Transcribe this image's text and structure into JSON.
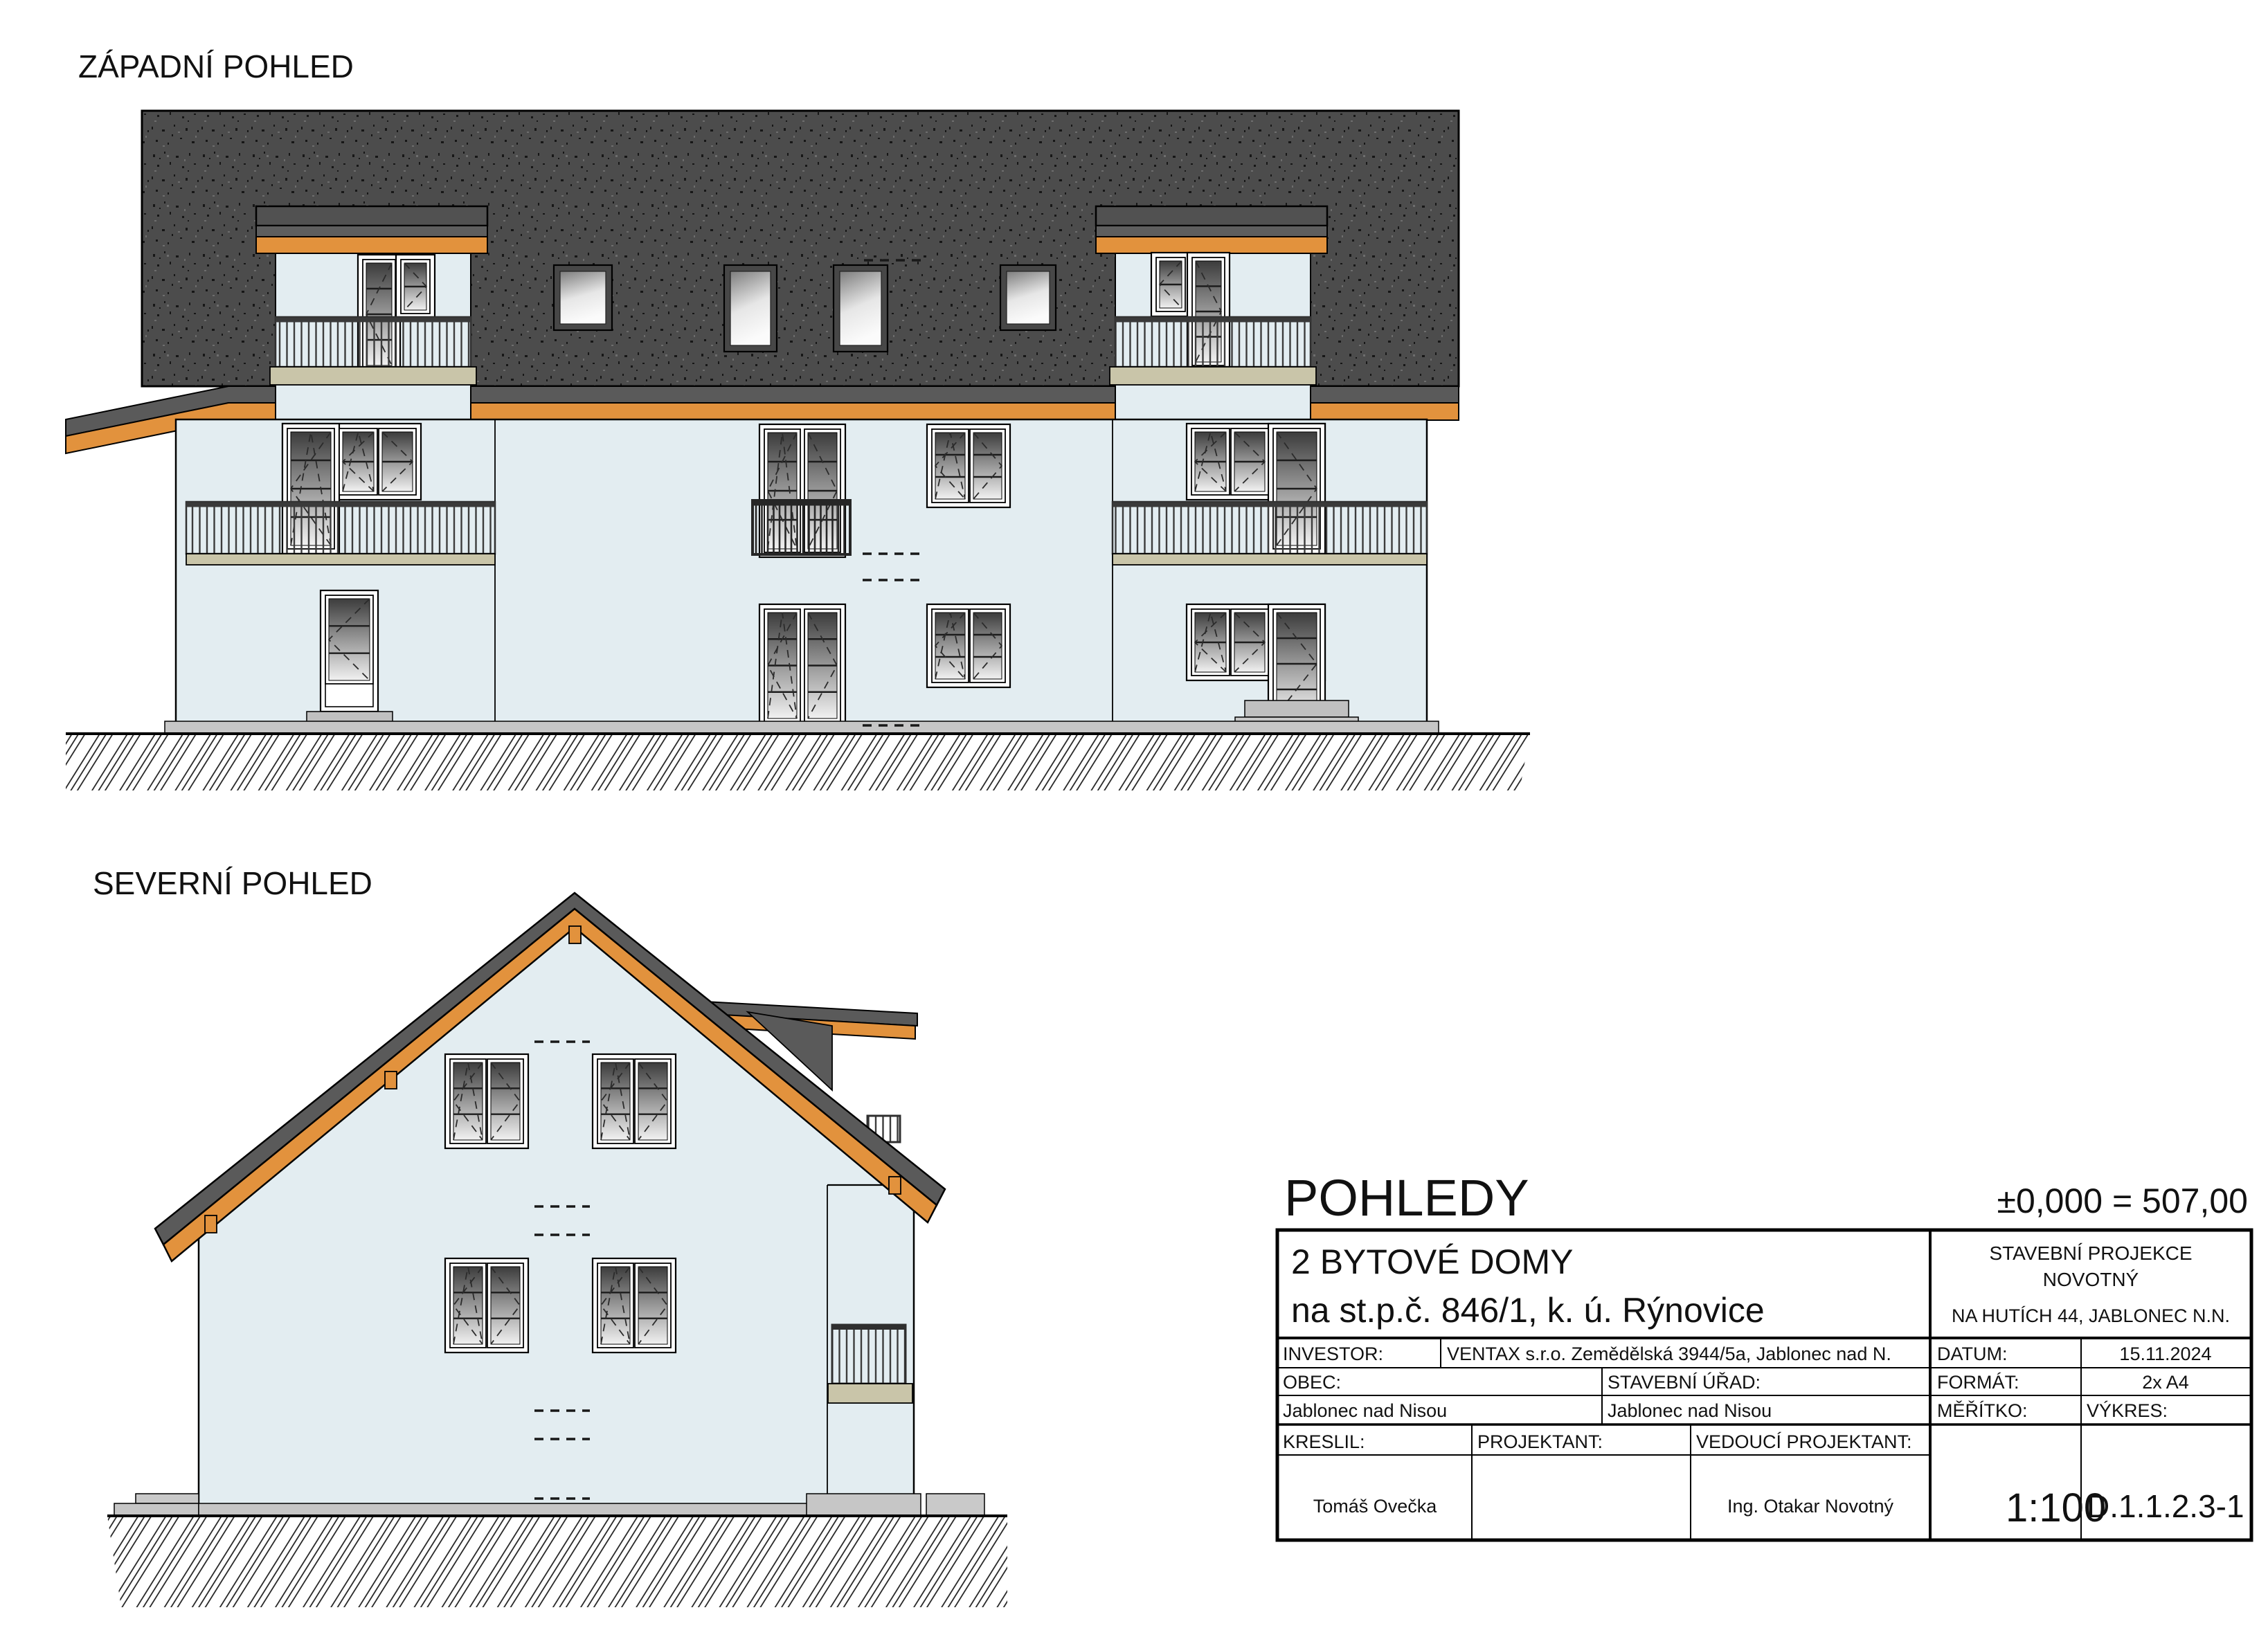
{
  "sheet": {
    "west_view_label": "ZÁPADNÍ POHLED",
    "north_view_label": "SEVERNÍ POHLED",
    "title": "POHLEDY",
    "level_note": "±0,000 = 507,00"
  },
  "title_block": {
    "project_line1": "2 BYTOVÉ DOMY",
    "project_line2": "na st.p.č. 846/1, k. ú. Rýnovice",
    "company_line1": "STAVEBNÍ PROJEKCE",
    "company_line2": "NOVOTNÝ",
    "company_line3": "NA HUTÍCH 44, JABLONEC N.N.",
    "investor_label": "INVESTOR:",
    "investor_value": "VENTAX s.r.o. Zemědělská 3944/5a, Jablonec nad N.",
    "datum_label": "DATUM:",
    "datum_value": "15.11.2024",
    "obec_label": "OBEC:",
    "obec_value": "Jablonec nad Nisou",
    "urad_label": "STAVEBNÍ ÚŘAD:",
    "urad_value": "Jablonec nad Nisou",
    "format_label": "FORMÁT:",
    "format_value": "2x A4",
    "meritko_label": "MĚŘÍTKO:",
    "meritko_value": "1:100",
    "vykres_label": "VÝKRES:",
    "vykres_value": "D.1.1.2.3-1",
    "kreslil_label": "KRESLIL:",
    "kreslil_value": "Tomáš Ovečka",
    "projektant_label": "PROJEKTANT:",
    "vedouci_label": "VEDOUCÍ PROJEKTANT:",
    "vedouci_value": "Ing. Otakar Novotný"
  },
  "colors": {
    "wall": "#e3edf1",
    "roof": "#4c4c4c",
    "fascia_orange": "#e2923d",
    "eaves_gray": "#5a5a5a",
    "slab_tan": "#c9c5a9"
  }
}
